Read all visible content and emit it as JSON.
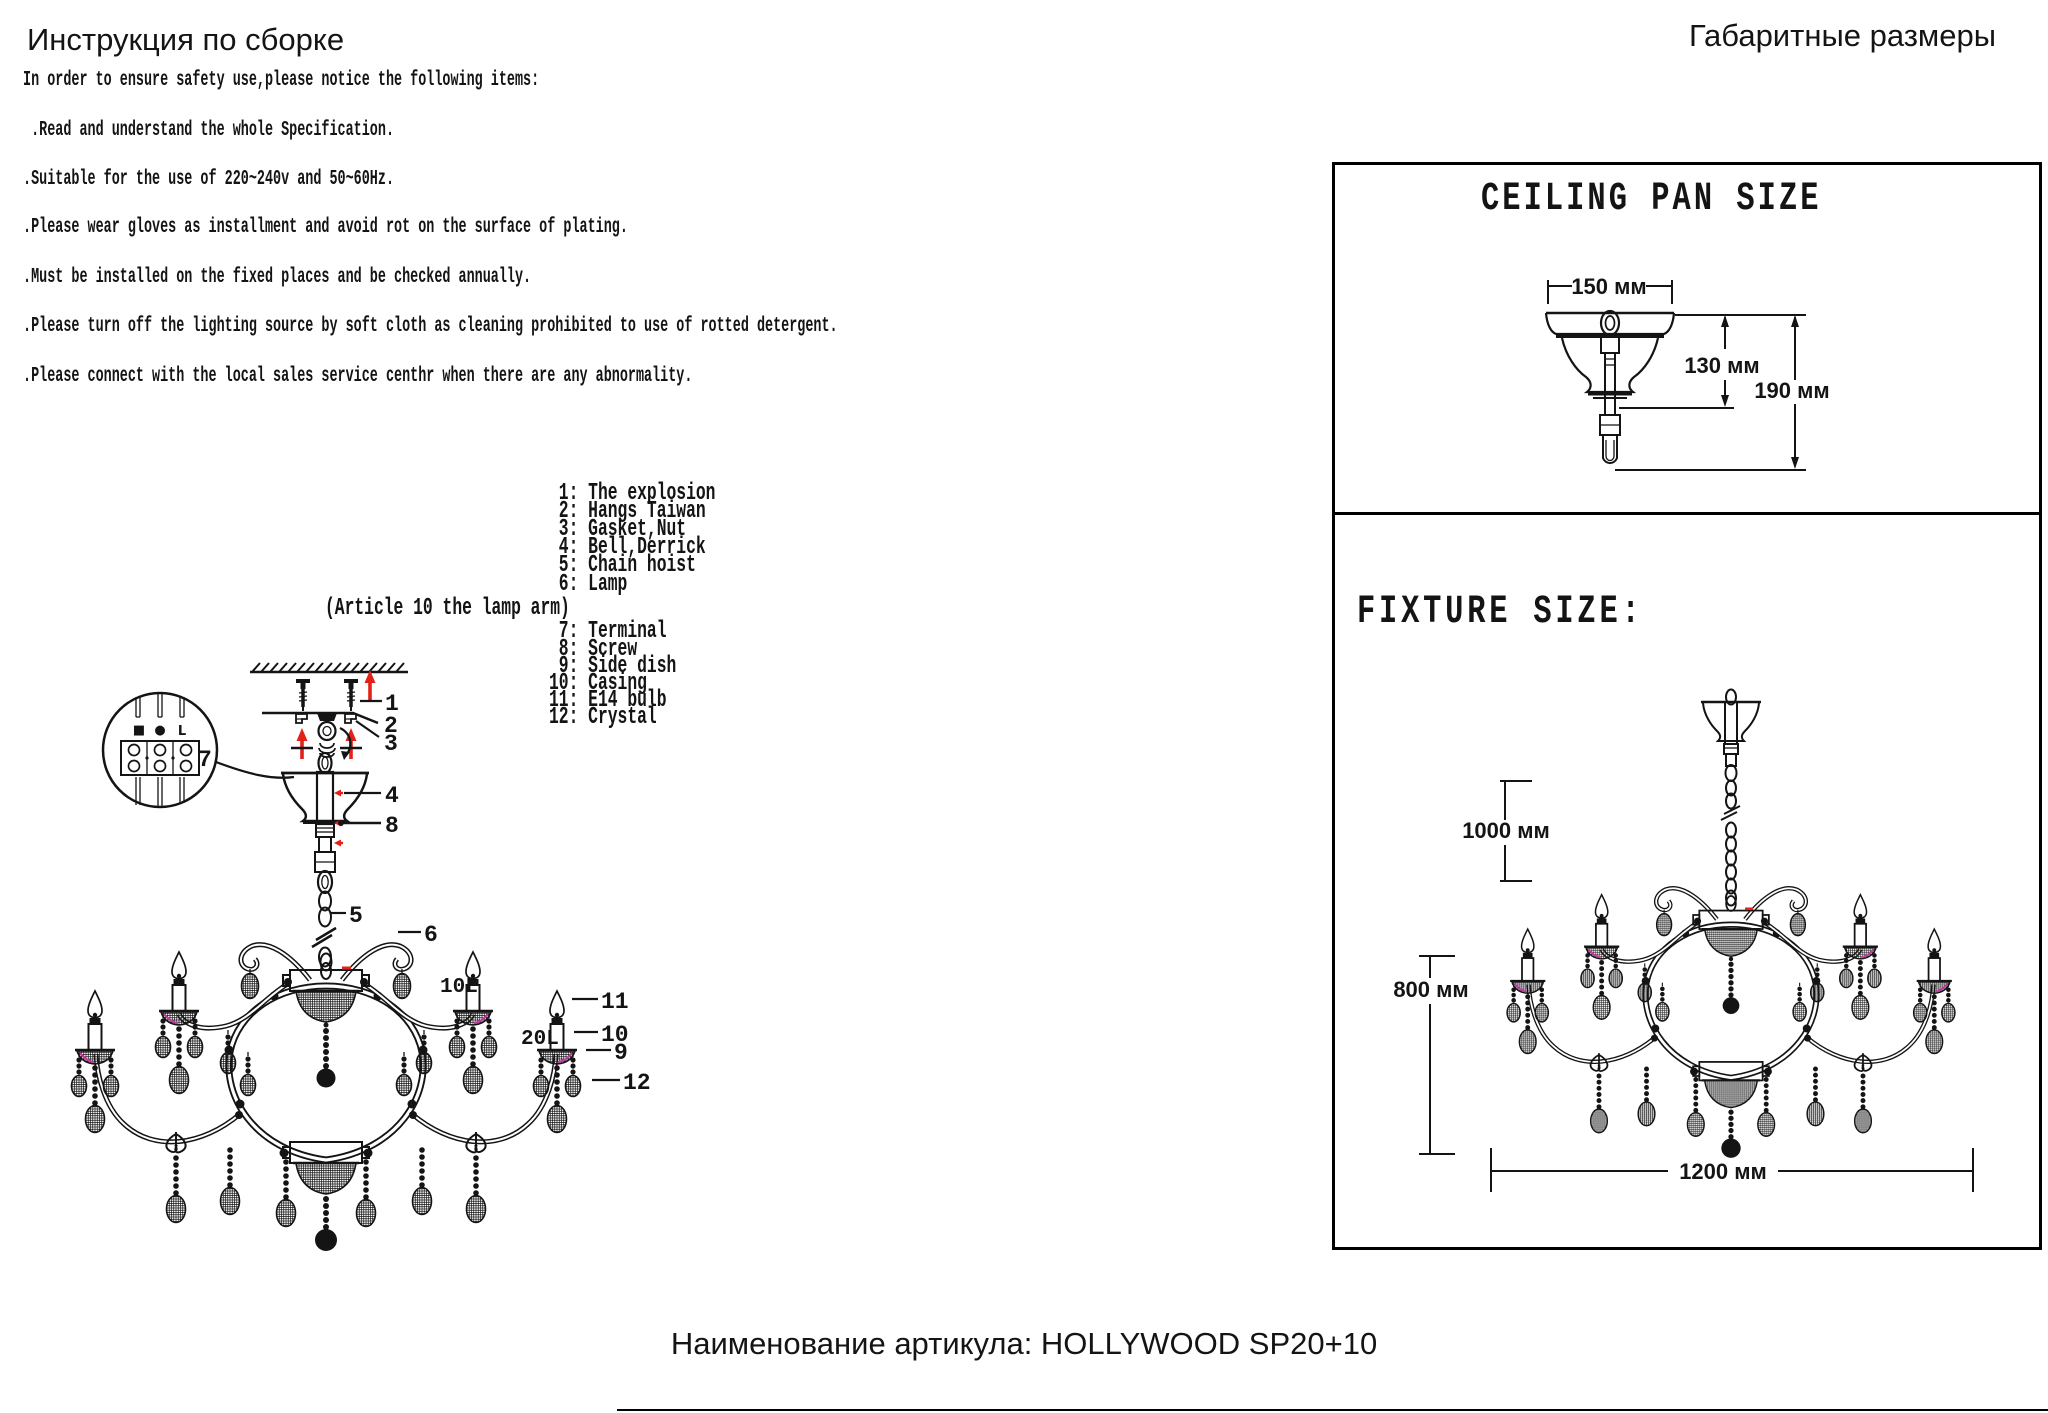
{
  "header": {
    "title_left": "Инструкция по сборке",
    "title_right": "Габаритные размеры"
  },
  "safety": {
    "intro": "In order to ensure safety use,please notice the following items:",
    "items": [
      " .Read and understand the whole Specification.",
      ".Suitable for the use of 220~240v and 50~60Hz.",
      ".Please wear gloves as installment and avoid rot on the surface of plating.",
      ".Must be installed on the fixed places and be checked annually.",
      ".Please turn off the lighting source by soft cloth as cleaning prohibited to use of rotted detergent.",
      ".Please connect with the local sales service centhr when there are any abnormality."
    ]
  },
  "parts_list": {
    "entries": [
      {
        "num": "1:",
        "label": "The explosion"
      },
      {
        "num": "2:",
        "label": "Hangs Taiwan"
      },
      {
        "num": "3:",
        "label": "Gasket,Nut"
      },
      {
        "num": "4:",
        "label": "Bell,Derrick"
      },
      {
        "num": "5:",
        "label": "Chain hoist"
      },
      {
        "num": "6:",
        "label": "Lamp"
      },
      {
        "num": "",
        "label": "(Article 10 the lamp arm)"
      },
      {
        "num": "7:",
        "label": "Terminal"
      },
      {
        "num": "8:",
        "label": "Screw"
      },
      {
        "num": "9:",
        "label": "Side dish"
      },
      {
        "num": "10:",
        "label": "Casing"
      },
      {
        "num": "11:",
        "label": "E14 bulb"
      },
      {
        "num": "12:",
        "label": "Crystal"
      }
    ]
  },
  "exploded_diagram": {
    "callouts": [
      "1",
      "2",
      "3",
      "4",
      "5",
      "6",
      "7",
      "8",
      "9",
      "10",
      "11",
      "12"
    ],
    "tier_upper": "10L",
    "tier_lower": "20L",
    "terminal_marks": [
      "■",
      "●",
      "L"
    ]
  },
  "size_panel": {
    "ceiling": {
      "title": "CEILING PAN SIZE",
      "dim_width": "150 мм",
      "dim_inner": "130 мм",
      "dim_total": "190 мм"
    },
    "fixture": {
      "title": "FIXTURE SIZE:",
      "dim_chain": "1000 мм",
      "dim_height": "800 мм",
      "dim_width": "1200 мм"
    }
  },
  "footer": {
    "article": "Наименование артикула: HOLLYWOOD SP20+10"
  },
  "colors": {
    "ink": "#141414",
    "accent_red": "#e32119",
    "accent_magenta": "#c13a9e"
  }
}
